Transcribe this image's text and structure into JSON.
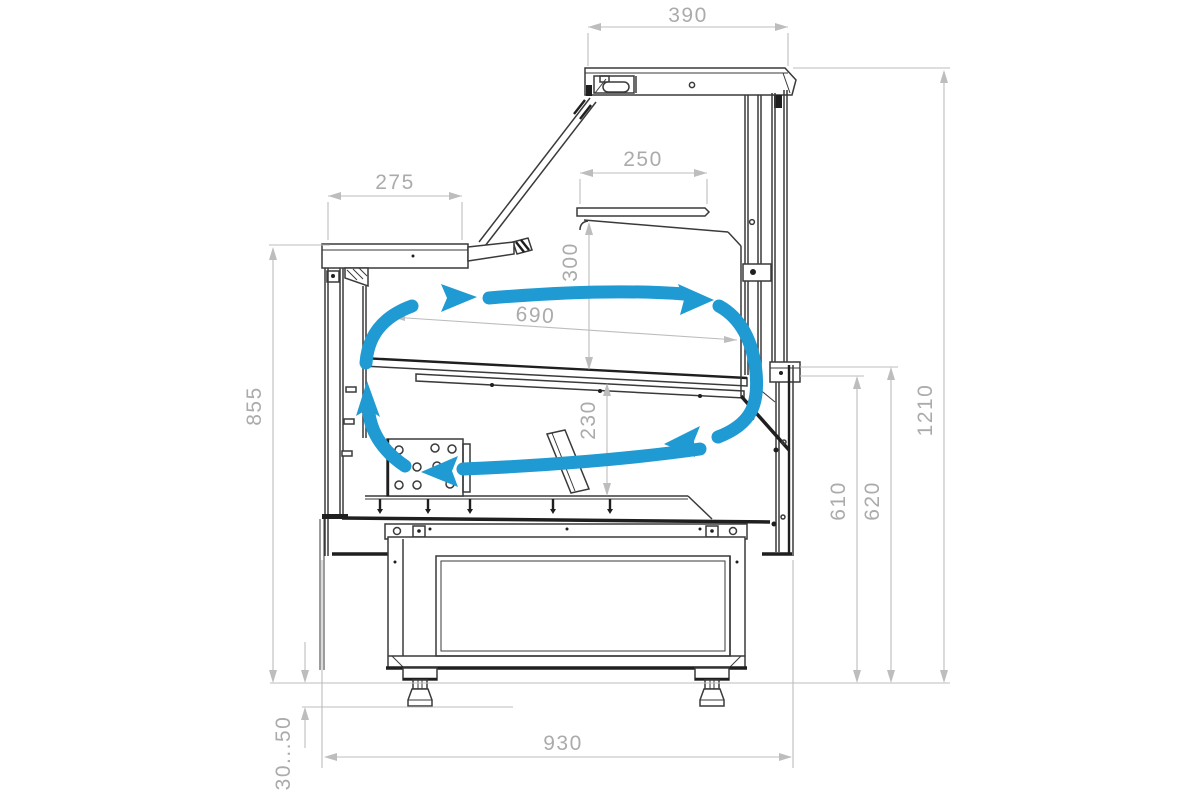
{
  "colors": {
    "blue": "#1f9ad2",
    "dim_line": "#bdbdbd",
    "dim_text": "#ababab",
    "ink": "#3a3a3a",
    "ink_dark": "#1f1f1f",
    "bg": "#ffffff"
  },
  "dims": {
    "canopy_depth": "390",
    "worktop_depth": "275",
    "shelf_depth": "250",
    "shelf_height": "300",
    "deck_length": "690",
    "well_depth": "230",
    "worktop_height": "855",
    "rear_height_inner": "610",
    "rear_height_outer": "620",
    "total_height": "1210",
    "body_depth": "930",
    "foot_adjust_range": "30...50"
  }
}
